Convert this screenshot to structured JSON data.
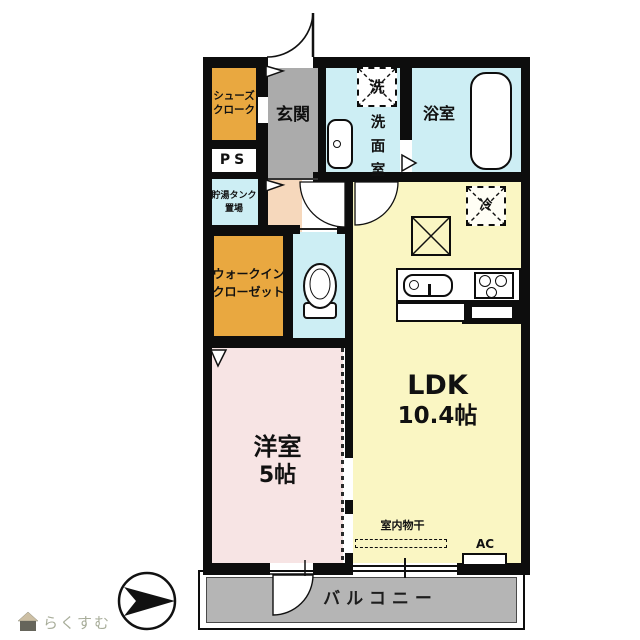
{
  "plan": {
    "shoes_closet": {
      "line1": "シューズ",
      "line2": "クローク"
    },
    "ps": {
      "label": "PS"
    },
    "entrance": {
      "label": "玄関"
    },
    "washer": {
      "label": "洗"
    },
    "washroom": {
      "chars": [
        "洗",
        "面",
        "室"
      ]
    },
    "bathroom": {
      "label": "浴室"
    },
    "tank": {
      "line1": "貯湯タンク",
      "line2": "置場"
    },
    "wic": {
      "line1": "ウォークイン",
      "line2": "クローゼット"
    },
    "western_room": {
      "name": "洋室",
      "size": "5帖"
    },
    "ldk": {
      "name": "LDK",
      "size": "10.4帖"
    },
    "fridge": {
      "label": "冷"
    },
    "indoor_drying": {
      "label": "室内物干"
    },
    "ac": {
      "label": "AC"
    },
    "balcony": {
      "label": "バルコニー"
    }
  },
  "watermark": {
    "label": "らくすむ"
  },
  "colors": {
    "closet_orange": "#E9A840",
    "entrance_gray": "#ABABAB",
    "wet_cyan": "#CDEEF4",
    "hall_peach": "#F6D8BC",
    "ldk_yellow": "#FAF6C3",
    "bedroom_pink": "#F7E4E4",
    "balcony_gray": "#B5B5B5",
    "wall_black": "#0d0d0d",
    "watermark_green": "#A8AD9A"
  }
}
